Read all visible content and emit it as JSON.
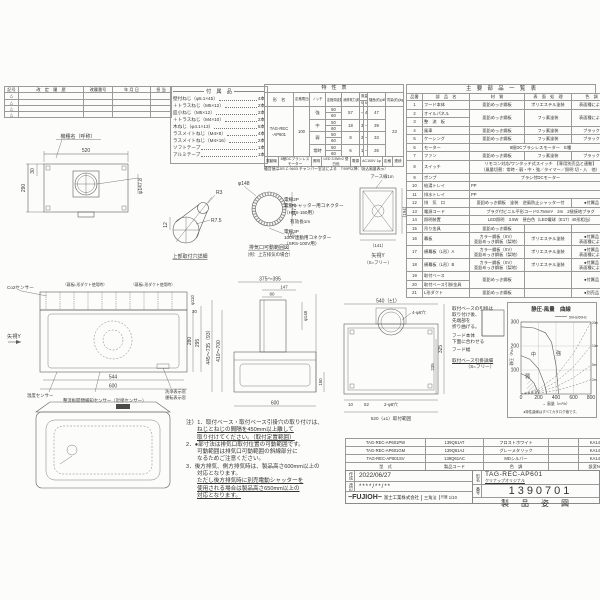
{
  "revision": {
    "headers": [
      "記号",
      "改　定　履　歴",
      "改履番号",
      "年 月 日",
      "担 当"
    ],
    "symbols": [
      "△",
      "△",
      "△",
      "△"
    ]
  },
  "nameplate": {
    "label": "機種名（呼称）"
  },
  "accessories": {
    "title": "付　属　品",
    "items": [
      {
        "name": "壁付ねじ（φ5.1×45）",
        "qty": "4本"
      },
      {
        "name": "＋トラスねじ（M5×12）",
        "qty": "2本"
      },
      {
        "name": "皿小ねじ（M5×12）",
        "qty": "2本"
      },
      {
        "name": "＋トラスねじ（M4×10）",
        "qty": "2本"
      },
      {
        "name": "木ねじ（φ4.1×13）",
        "qty": "6本"
      },
      {
        "name": "ラスメイトねじ（M4×8）",
        "qty": "4本"
      },
      {
        "name": "ラスメイトねじ（M4×16）",
        "qty": "2本"
      },
      {
        "name": "ソフトテープ",
        "qty": "1本"
      },
      {
        "name": "アルミテープ",
        "qty": "1本"
      }
    ]
  },
  "spec": {
    "title": "特　性　表",
    "headers": {
      "model": "形　名",
      "voltage": "定格電圧(V)",
      "notch": "ノッチ",
      "freq": "定格周波数(Hz)",
      "power": "消費電力(約)(W)",
      "airflow": "風量(m³/h)",
      "air50": "50Hz",
      "air60": "60Hz",
      "noise": "騒音(約)(dB)",
      "weight": "質量(約)(kg)"
    },
    "model1": "TAG-REC",
    "model2": "-AP601",
    "voltage": "100",
    "rows": [
      {
        "notch": "強",
        "f1": "50",
        "f2": "60",
        "power": "57",
        "a1": "—",
        "a2": "420",
        "noise": "47"
      },
      {
        "notch": "中",
        "f1": "50",
        "f2": "60",
        "power": "18",
        "a1": "300",
        "a2": "—",
        "noise": "39"
      },
      {
        "notch": "弱",
        "f1": "50",
        "f2": "60",
        "power": "8",
        "a1": "210",
        "a2": "—",
        "noise": "33"
      },
      {
        "notch": "常時",
        "f1": "50",
        "f2": "60",
        "power": "6",
        "a1": "160",
        "a2": "—",
        "noise": "26"
      }
    ],
    "weight": "23",
    "footer_cells": [
      "電動機",
      "8極DCブラシレスモーター",
      "照明",
      "LED 3.5W×2 昼白色",
      "電源",
      "AC100V 1φ",
      "定格",
      "連続"
    ],
    "footer_note": "騒音値はJIS C 9603 チャンバー室法による　（'99P以降：吸込風量表示）"
  },
  "parts": {
    "title": "主　要　部　品　一　覧　表",
    "headers": [
      "品番",
      "部　品　名",
      "材　質",
      "表　面　処　理",
      "色　調"
    ],
    "rows": [
      {
        "no": "1",
        "name": "フード本体",
        "mat": "亜鉛めっき鋼板",
        "surf": "ポリエステル塗装",
        "color": "表面種による"
      },
      {
        "no": "2",
        "name": "オイルパネル",
        "mat": "亜鉛めっき鋼板",
        "surf": "フッ素塗装",
        "color": "表面種による"
      },
      {
        "no": "3",
        "name": "整　流　板"
      },
      {
        "no": "4",
        "name": "風車",
        "mat": "亜鉛めっき鋼板",
        "surf": "フッ素塗装",
        "color": "ブラック"
      },
      {
        "no": "5",
        "name": "ケーシング",
        "mat": "亜鉛めっき鋼板",
        "surf": "フッ素塗装",
        "color": "ブラック"
      },
      {
        "no": "6",
        "name": "モーター",
        "span": "8極DCブラシレスモーター　E種"
      },
      {
        "no": "7",
        "name": "ファン",
        "mat": "亜鉛めっき鋼板",
        "surf": "フッ素塗装",
        "color": "ブラック"
      },
      {
        "no": "8",
        "name": "スイッチ",
        "span": "リモコン対応/ワンタッチ式スイッチ　【専用別売品と連動】",
        "span2": "（風量切替：常時・弱・中・強／タイマー／照明 切・入　他）"
      },
      {
        "no": "9",
        "name": "ポンプ",
        "span": "ブラシ付DCモーター"
      },
      {
        "no": "10",
        "name": "給湯トレイ",
        "span": "PP"
      },
      {
        "no": "11",
        "name": "排水トレイ",
        "span": "PP"
      },
      {
        "no": "12",
        "name": "排　気　口",
        "mat": "亜鉛めっき鋼板　塗装　逆風防止シャッター付",
        "color": "●付属品"
      },
      {
        "no": "13",
        "name": "電源コード",
        "span": "プラグ付ビニル平形コード0.75mm²　2m　2極接地プラグ"
      },
      {
        "no": "14",
        "name": "照明装置",
        "span": "LED照明　3.5W　昼白色（LED電球（E17）40形相当）"
      },
      {
        "no": "15",
        "name": "吊り金具",
        "mat": "亜鉛めっき鋼板"
      },
      {
        "no": "16",
        "name": "幕板",
        "mat1": "カラー鋼板（SV）",
        "mat2": "亜鉛めっき鋼板（梨地）",
        "surf": "ポリエステル塗装",
        "color1": "●付属品",
        "color2": "表面種による"
      },
      {
        "no": "17",
        "name": "横幕板（L形）A",
        "mat1": "カラー鋼板（SV）",
        "mat2": "亜鉛めっき鋼板（梨地）",
        "surf": "ポリエステル塗装",
        "color1": "●付属品",
        "color2": "表面種による"
      },
      {
        "no": "18",
        "name": "横幕板（L形）B",
        "mat1": "カラー鋼板（SV）",
        "mat2": "亜鉛めっき鋼板（梨地）",
        "surf": "ポリエステル塗装",
        "color1": "●付属品",
        "color2": "表面種による"
      },
      {
        "no": "19",
        "name": "取付ベース",
        "mat": "亜鉛めっき鋼板",
        "color": "●付属品"
      },
      {
        "no": "20",
        "name": "取付ベース引掛金具"
      },
      {
        "no": "21",
        "name": "L形ダクト",
        "mat": "亜鉛めっき鋼板",
        "color": "●別売品"
      }
    ]
  },
  "plan": {
    "d_w": "520",
    "d_h": "290",
    "d_30": "30",
    "d_duct": "φ147.8"
  },
  "keyhole": {
    "label": "上部取付穴詳細",
    "d12": "12",
    "r3": "R3",
    "r75": "R7.5"
  },
  "range_circle": {
    "label1": "排気口可動範囲図",
    "label2": "（例：上方排気の場合）",
    "d148": "φ148",
    "d1478": "147.8",
    "d6": "（6）"
  },
  "connectors": {
    "l1": "電線2P",
    "l2": "電動シャッター用コネクター",
    "l3": "（HDS-150用）",
    "l4": "有効長1m",
    "l5": "電線3P",
    "l6": "100V連動用コネクター",
    "l7": "（SRS-100V用）"
  },
  "rear_mini": {
    "earth": "アース線1m",
    "d141": "（141）",
    "d194": "（194）",
    "label1": "矢視Y",
    "label2": "（S=フリー）"
  },
  "front": {
    "co2": "Co2センサー",
    "makuita_l": "（幕板L形ダクト使用時）",
    "makuita_r": "（幕板L形ダクト使用時）",
    "arrow": "矢視Y",
    "d544": "544",
    "d600": "600",
    "d280": "280",
    "d295": "295",
    "d30": "30",
    "d110": "φ110",
    "temp": "温度センサー",
    "prox": "整流板開閉検知センサー（近接センサー）",
    "wash": "洗浄表示窓",
    "run": "運転表示窓"
  },
  "side": {
    "d375": "375～395",
    "d147": "147",
    "d80": "80",
    "d148": "φ148",
    "d445": "445～735（93）",
    "d410": "410～700",
    "d600": "600",
    "d150": "150"
  },
  "rear": {
    "d540": "540（±1）",
    "holes6": "4-φ6穴",
    "d325": "325",
    "d235": "235",
    "d10": "10",
    "d52": "52",
    "holes8": "2-φ8穴",
    "range": "520（±1）取付範囲"
  },
  "base_notes": {
    "l1": "取付ベースの引掛は",
    "l2": "取り付け後、",
    "l3": "先端部を",
    "l4": "折り曲げる。",
    "l5": "フード本体",
    "l6": "下面に合わせる",
    "l7": "フード幅",
    "l8": "取付ベース引掛詳細",
    "l9": "（S=フリー）"
  },
  "notes": {
    "lines": [
      "注）1．取付ベース・取付ベース引掛穴の取り付けは、",
      "ねじとねじの間隔を450mm以上離して",
      "取り付けてください。（取付定置範囲）",
      "2．●部寸法は排気口取付位置の可動範囲です。",
      "可動範囲は排気口可動範囲の斜線部分に",
      "なるためご注意ください。",
      "3．後方排気、側方排気時は、製品高さ600mm以上の",
      "対応となります。",
      "ただし後方排気時に別売電動シャッターを",
      "使用される場合は製品高さ650mm以上の",
      "対応となります。"
    ]
  },
  "models": {
    "headers": [
      "型　式",
      "製品コード",
      "色　調",
      "",
      "設変No."
    ],
    "rows": [
      [
        "TAG-REC-AP601PW",
        "139Q61AT",
        "フロストホワイト",
        "",
        "KA140"
      ],
      [
        "TAG-REC-AP601GM",
        "139Q61AJ",
        "グレーメタリック",
        "",
        "KA140"
      ],
      [
        "TAG-REC-AP601SV",
        "139Q61AC",
        "MDシルバー",
        "",
        "KA140"
      ]
    ]
  },
  "title_block": {
    "date_label": "作成",
    "date": "2022/06/27",
    "rev_label": "改訂",
    "rev_date": "****/**/**",
    "company_logo": "−FUJIOH−",
    "company": "富士工業株式会社",
    "projection": "三角法",
    "scale_label": "尺度",
    "scale": "1/10",
    "model_label": "形名",
    "model": "TAG-REC-AP601",
    "model_sub": "クリナップオリジナル",
    "no_label": "番号",
    "drawing_no": "1390701",
    "doc_title": "製　品　姿　図"
  },
  "chart_data": {
    "type": "line",
    "title": "静圧-風量　曲線",
    "legend": [
      "50Hz/60Hz"
    ],
    "xlabel": "→ 風量（m³/h）",
    "ylabel": "→ 静圧（Pa）",
    "xlim": [
      0,
      800
    ],
    "ylim": [
      0,
      300
    ],
    "x_ticks": [
      0,
      200,
      400,
      600,
      800
    ],
    "y_ticks": [
      100,
      200,
      300
    ],
    "grid": true,
    "legend_position": "top-right",
    "note": "●特性曲線はすべてカタログ値です。",
    "series": [
      {
        "name": "強",
        "style": "solid",
        "points": [
          [
            0,
            280
          ],
          [
            150,
            275
          ],
          [
            280,
            255
          ],
          [
            350,
            215
          ],
          [
            400,
            120
          ],
          [
            430,
            0
          ]
        ]
      },
      {
        "name": "中",
        "style": "solid",
        "points": [
          [
            0,
            160
          ],
          [
            100,
            145
          ],
          [
            200,
            105
          ],
          [
            270,
            40
          ],
          [
            295,
            0
          ]
        ]
      },
      {
        "name": "弱",
        "style": "solid",
        "points": [
          [
            0,
            85
          ],
          [
            80,
            72
          ],
          [
            150,
            45
          ],
          [
            205,
            0
          ]
        ]
      },
      {
        "name": "2m",
        "style": "dashed",
        "points": [
          [
            0,
            0
          ],
          [
            200,
            4
          ],
          [
            400,
            15
          ],
          [
            600,
            34
          ],
          [
            800,
            60
          ]
        ]
      },
      {
        "name": "5m",
        "style": "dashed",
        "points": [
          [
            0,
            0
          ],
          [
            200,
            8
          ],
          [
            400,
            30
          ],
          [
            600,
            68
          ],
          [
            800,
            120
          ]
        ]
      },
      {
        "name": "10m",
        "style": "dashed",
        "points": [
          [
            0,
            0
          ],
          [
            200,
            13
          ],
          [
            400,
            50
          ],
          [
            600,
            113
          ],
          [
            800,
            200
          ]
        ]
      },
      {
        "name": "20m",
        "style": "dashed",
        "points": [
          [
            0,
            0
          ],
          [
            200,
            19
          ],
          [
            400,
            75
          ],
          [
            600,
            169
          ],
          [
            800,
            300
          ]
        ]
      }
    ]
  }
}
